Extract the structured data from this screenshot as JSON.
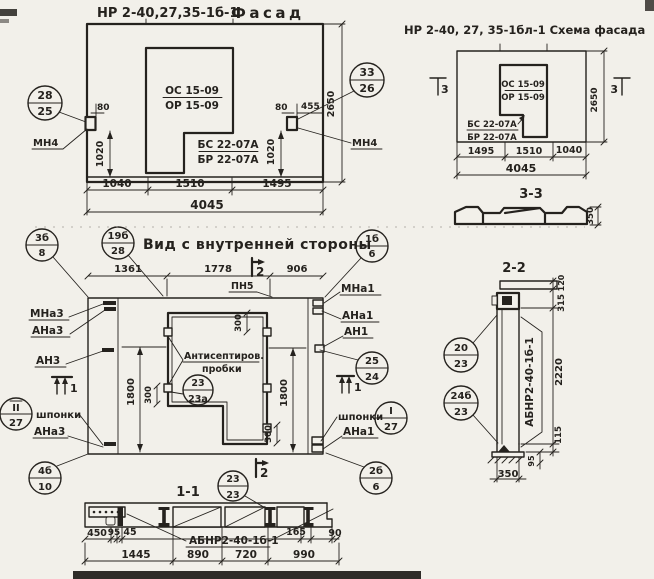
{
  "colors": {
    "paper": "#f2f0ea",
    "ink": "#25221e"
  },
  "facade": {
    "title_code": "НР 2-40,27,35-1б-1",
    "title_word": "Фасад",
    "frac1_top": "ОС 15-09",
    "frac1_bot": "ОР 15-09",
    "frac2_top": "БС 22-07А",
    "frac2_bot": "БР 22-07А",
    "callout_left": {
      "top": "28",
      "bot": "25"
    },
    "callout_right": {
      "top": "33",
      "bot": "26"
    },
    "mn4_left": "МН4",
    "mn4_right": "МН4",
    "dim_80_left": "80",
    "dim_80_right": "80",
    "dim_455": "455",
    "dim_1020_left": "1020",
    "dim_1020_right": "1020",
    "dim_2650": "2650",
    "dim_w1": "1040",
    "dim_w2": "1510",
    "dim_w3": "1495",
    "dim_total": "4045"
  },
  "schema": {
    "title": "НР 2-40, 27, 35-1бл-1 Схема фасада",
    "frac1_top": "ОС 15-09",
    "frac1_bot": "ОР 15-09",
    "frac2_top": "БС 22-07А",
    "frac2_bot": "БР 22-07А",
    "marker_left": "3",
    "marker_right": "3",
    "dim_2650": "2650",
    "dim_w1": "1495",
    "dim_w2": "1510",
    "dim_w3": "1040",
    "dim_total": "4045",
    "section_title": "3-3",
    "dim_350": "350"
  },
  "inner": {
    "title": "Вид с внутренней стороны",
    "dim_w1": "1361",
    "dim_w2": "1778",
    "dim_w3": "906",
    "marker_top": "2",
    "marker_bottom": "2",
    "marker_left": "1",
    "marker_right": "1",
    "labels": {
      "pn5": "ПН5",
      "mna3": "МНа3",
      "ana3": "АНа3",
      "an3": "АН3",
      "shponki_left": "шпонки",
      "ana3_2": "АНа3",
      "mna1": "МНа1",
      "ana1": "АНа1",
      "an1": "АН1",
      "shponki_right": "шпонки",
      "ana1_2": "АНа1",
      "anti1": "Антисептиров.",
      "anti2": "пробки"
    },
    "d1800_left": "1800",
    "d1800_right": "1800",
    "d300_top": "300",
    "d300_left": "300",
    "d300_bottom": "300",
    "callouts": {
      "c_3b8": {
        "top": "3б",
        "bot": "8"
      },
      "c_19b28": {
        "top": "19б",
        "bot": "28"
      },
      "c_1b6": {
        "top": "1б",
        "bot": "6"
      },
      "c_II27": {
        "top": "II",
        "bot": "27"
      },
      "c_2524": {
        "top": "25",
        "bot": "24"
      },
      "c_I27": {
        "top": "I",
        "bot": "27"
      },
      "c_2b6": {
        "top": "2б",
        "bot": "6"
      },
      "c_2323a": {
        "top": "23",
        "bot": "23а"
      },
      "c_4b10": {
        "top": "4б",
        "bot": "10"
      }
    }
  },
  "sec11": {
    "title": "1-1",
    "callout": {
      "top": "23",
      "bot": "23"
    },
    "label": "АБНР2-40-1б-1",
    "dims": {
      "d450": "450",
      "d95": "95",
      "d45": "45",
      "d1445": "1445",
      "d890": "890",
      "d720": "720",
      "d990": "990",
      "d165": "165",
      "d90": "90"
    }
  },
  "sec22": {
    "title": "2-2",
    "label": "АБНР2-40-1б-1",
    "callout1": {
      "top": "20",
      "bot": "23"
    },
    "callout2": {
      "top": "24б",
      "bot": "23"
    },
    "dims": {
      "d120": "120",
      "d315": "315",
      "d2220": "2220",
      "d115": "115",
      "d95": "95",
      "d350": "350"
    }
  }
}
